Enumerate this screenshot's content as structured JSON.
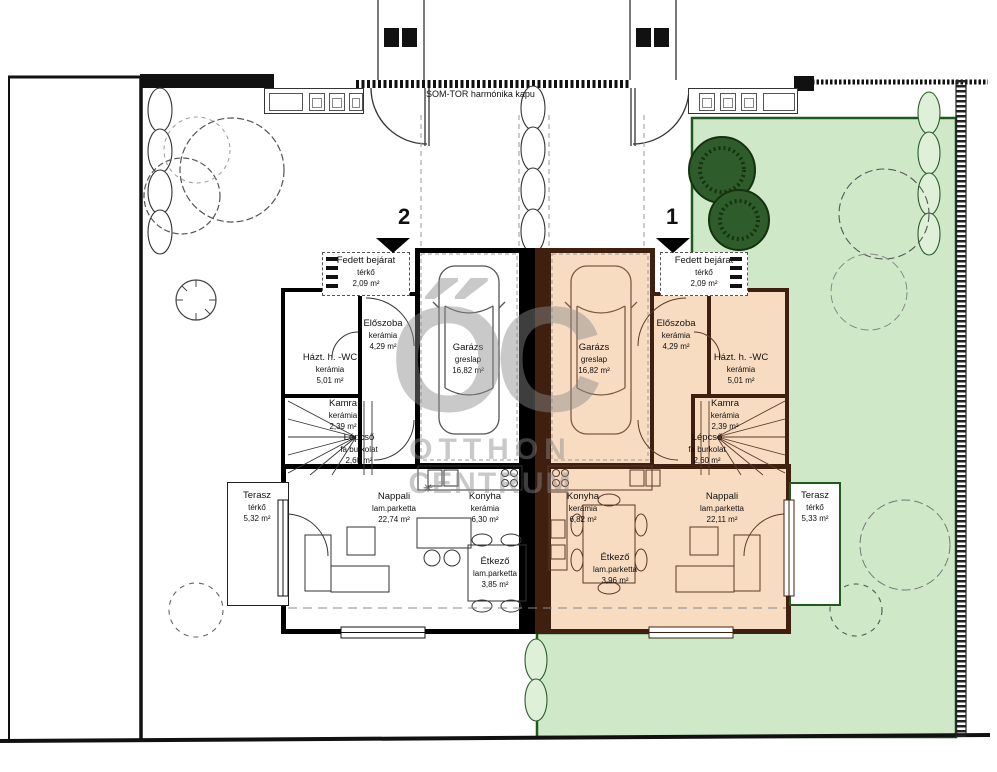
{
  "site": {
    "gate_label": "SOM-TOR  harmónika kapu",
    "marker_left": "2",
    "marker_right": "1"
  },
  "watermark": {
    "monogram": "ŐC",
    "line1": "OTTHON",
    "line2": "CENTRUM"
  },
  "symbols": {
    "boiler": "✳"
  },
  "rooms": {
    "left": {
      "fedett_bejarat": {
        "name": "Fedett bejárat",
        "material": "térkő",
        "area": "2,09 m²"
      },
      "eloszoba": {
        "name": "Előszoba",
        "material": "kerámia",
        "area": "4,29 m²"
      },
      "garazs": {
        "name": "Garázs",
        "material": "greslap",
        "area": "16,82 m²"
      },
      "hazt_wc": {
        "name": "Házt. h. -WC",
        "material": "kerámia",
        "area": "5,01 m²"
      },
      "kamra": {
        "name": "Kamra",
        "material": "kerámia",
        "area": "2,39 m²"
      },
      "lepcso": {
        "name": "Lépcső",
        "material": "fa burkolat",
        "area": "2,60 m²"
      },
      "nappali": {
        "name": "Nappali",
        "material": "lam.parketta",
        "area": "22,74 m²"
      },
      "konyha": {
        "name": "Konyha",
        "material": "kerámia",
        "area": "6,30 m²"
      },
      "etkezo": {
        "name": "Étkező",
        "material": "lam.parketta",
        "area": "3,85 m²"
      },
      "terasz": {
        "name": "Terasz",
        "material": "térkő",
        "area": "5,32 m²"
      }
    },
    "right": {
      "fedett_bejarat": {
        "name": "Fedett bejárat",
        "material": "térkő",
        "area": "2,09 m²"
      },
      "eloszoba": {
        "name": "Előszoba",
        "material": "kerámia",
        "area": "4,29 m²"
      },
      "garazs": {
        "name": "Garázs",
        "material": "greslap",
        "area": "16,82 m²"
      },
      "hazt_wc": {
        "name": "Házt. h. -WC",
        "material": "kerámia",
        "area": "5,01 m²"
      },
      "kamra": {
        "name": "Kamra",
        "material": "kerámia",
        "area": "2,39 m²"
      },
      "lepcso": {
        "name": "Lépcső",
        "material": "fa burkolat",
        "area": "2,60 m²"
      },
      "konyha": {
        "name": "Konyha",
        "material": "kerámia",
        "area": "6,82 m²"
      },
      "etkezo": {
        "name": "Étkező",
        "material": "lam.parketta",
        "area": "3,96 m²"
      },
      "nappali": {
        "name": "Nappali",
        "material": "lam.parketta",
        "area": "22,11 m²"
      },
      "terasz": {
        "name": "Terasz",
        "material": "térkő",
        "area": "5,33 m²"
      }
    }
  },
  "colors": {
    "left_wall": "#000000",
    "right_wall": "#3f2010",
    "right_floor": "#f8dcc2",
    "garden_fill": "#cfe9c8",
    "garden_border": "#1e5c1e",
    "watermark_grey": "#8a8a8a"
  }
}
